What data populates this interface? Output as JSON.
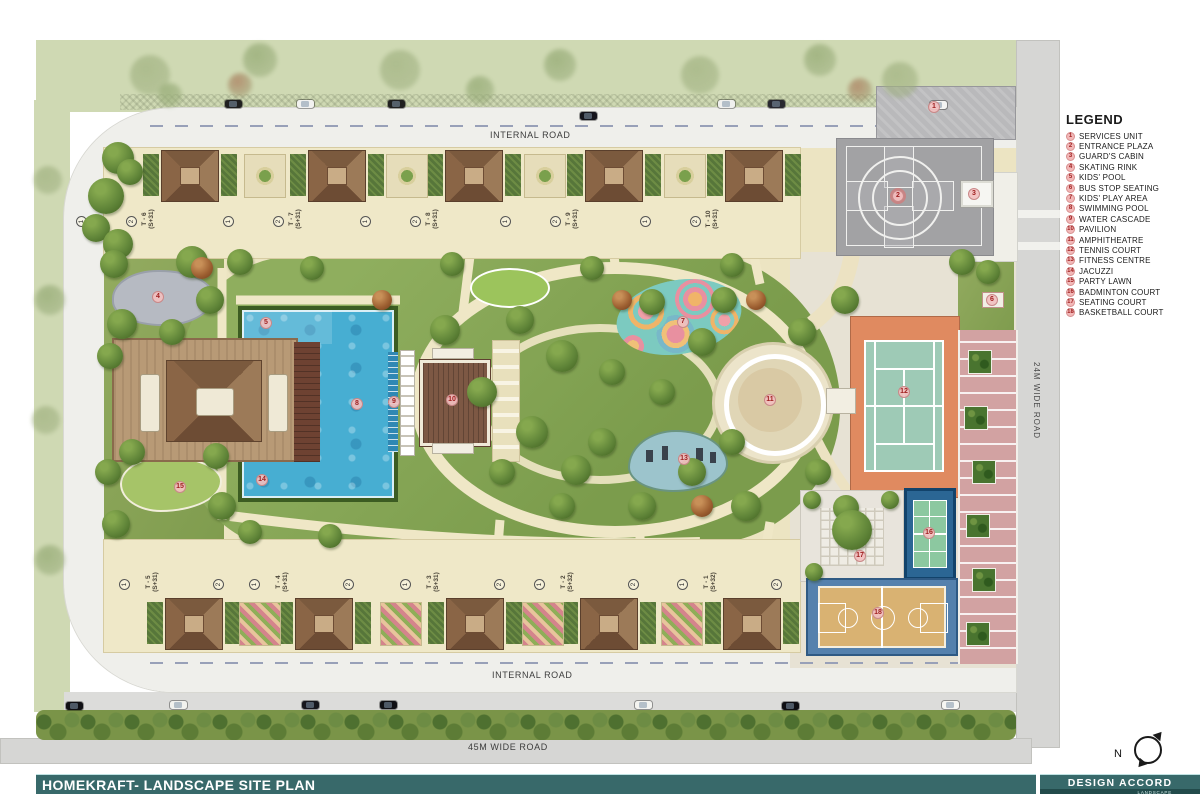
{
  "title_bar": {
    "text": "HOMEKRAFT- LANDSCAPE SITE PLAN"
  },
  "branding": {
    "name": "DESIGN ACCORD",
    "subtitle": "LANDSCAPE",
    "north_label": "N"
  },
  "roads": {
    "top_label": "INTERNAL ROAD",
    "bottom_inner_label": "INTERNAL ROAD",
    "bottom_outer_label": "45M WIDE ROAD",
    "right_label": "24M WIDE ROAD"
  },
  "legend": {
    "title": "LEGEND",
    "items": [
      {
        "num": "1",
        "label": "SERVICES UNIT"
      },
      {
        "num": "2",
        "label": "ENTRANCE PLAZA"
      },
      {
        "num": "3",
        "label": "GUARD'S CABIN"
      },
      {
        "num": "4",
        "label": "SKATING RINK"
      },
      {
        "num": "5",
        "label": "KIDS' POOL"
      },
      {
        "num": "6",
        "label": "BUS STOP SEATING"
      },
      {
        "num": "7",
        "label": "KIDS' PLAY AREA"
      },
      {
        "num": "8",
        "label": "SWIMMING POOL"
      },
      {
        "num": "9",
        "label": "WATER CASCADE"
      },
      {
        "num": "10",
        "label": "PAVILION"
      },
      {
        "num": "11",
        "label": "AMPHITHEATRE"
      },
      {
        "num": "12",
        "label": "TENNIS COURT"
      },
      {
        "num": "13",
        "label": "FITNESS CENTRE"
      },
      {
        "num": "14",
        "label": "JACUZZI"
      },
      {
        "num": "15",
        "label": "PARTY LAWN"
      },
      {
        "num": "16",
        "label": "BADMINTON COURT"
      },
      {
        "num": "17",
        "label": "SEATING COURT"
      },
      {
        "num": "18",
        "label": "BASKETBALL COURT"
      }
    ]
  },
  "towers": {
    "unit_markers": [
      "1",
      "2"
    ],
    "top_row": [
      {
        "name": "T - 6",
        "floors": "(S+31)",
        "x": 148
      },
      {
        "name": "T - 7",
        "floors": "(S+31)",
        "x": 295
      },
      {
        "name": "T - 8",
        "floors": "(S+31)",
        "x": 432
      },
      {
        "name": "T - 9",
        "floors": "(S+31)",
        "x": 572
      },
      {
        "name": "T - 10",
        "floors": "(S+31)",
        "x": 712
      }
    ],
    "bottom_row": [
      {
        "name": "T - 5",
        "floors": "(S+31)",
        "x": 152
      },
      {
        "name": "T - 4",
        "floors": "(S+31)",
        "x": 282
      },
      {
        "name": "T - 3",
        "floors": "(S+31)",
        "x": 433
      },
      {
        "name": "T - 2",
        "floors": "(S+32)",
        "x": 567
      },
      {
        "name": "T - 1",
        "floors": "(S+32)",
        "x": 710
      }
    ]
  },
  "plan_markers": [
    {
      "n": "1",
      "x": 934,
      "y": 107
    },
    {
      "n": "2",
      "x": 898,
      "y": 196
    },
    {
      "n": "3",
      "x": 974,
      "y": 194
    },
    {
      "n": "4",
      "x": 158,
      "y": 297
    },
    {
      "n": "5",
      "x": 266,
      "y": 323
    },
    {
      "n": "6",
      "x": 992,
      "y": 300
    },
    {
      "n": "7",
      "x": 683,
      "y": 322
    },
    {
      "n": "8",
      "x": 357,
      "y": 404
    },
    {
      "n": "9",
      "x": 394,
      "y": 402
    },
    {
      "n": "10",
      "x": 452,
      "y": 400
    },
    {
      "n": "11",
      "x": 770,
      "y": 400
    },
    {
      "n": "12",
      "x": 904,
      "y": 392
    },
    {
      "n": "13",
      "x": 684,
      "y": 459
    },
    {
      "n": "14",
      "x": 262,
      "y": 480
    },
    {
      "n": "15",
      "x": 180,
      "y": 487
    },
    {
      "n": "16",
      "x": 929,
      "y": 533
    },
    {
      "n": "17",
      "x": 860,
      "y": 556
    },
    {
      "n": "18",
      "x": 878,
      "y": 613
    }
  ],
  "colors": {
    "bar_teal": "#38696a",
    "marker_red": "#a02020",
    "marker_pink": "#f2b8b8",
    "pool_blue": "#47aed2",
    "tennis_surround": "#e08a60",
    "tennis_court": "#9ecab6",
    "basketball_court": "#d9b272",
    "badminton_court": "#8cc8a0",
    "paver_pink": "#d2a2a2",
    "roof_brown": "#8a6546",
    "plinth_beige": "#efe8c8"
  }
}
